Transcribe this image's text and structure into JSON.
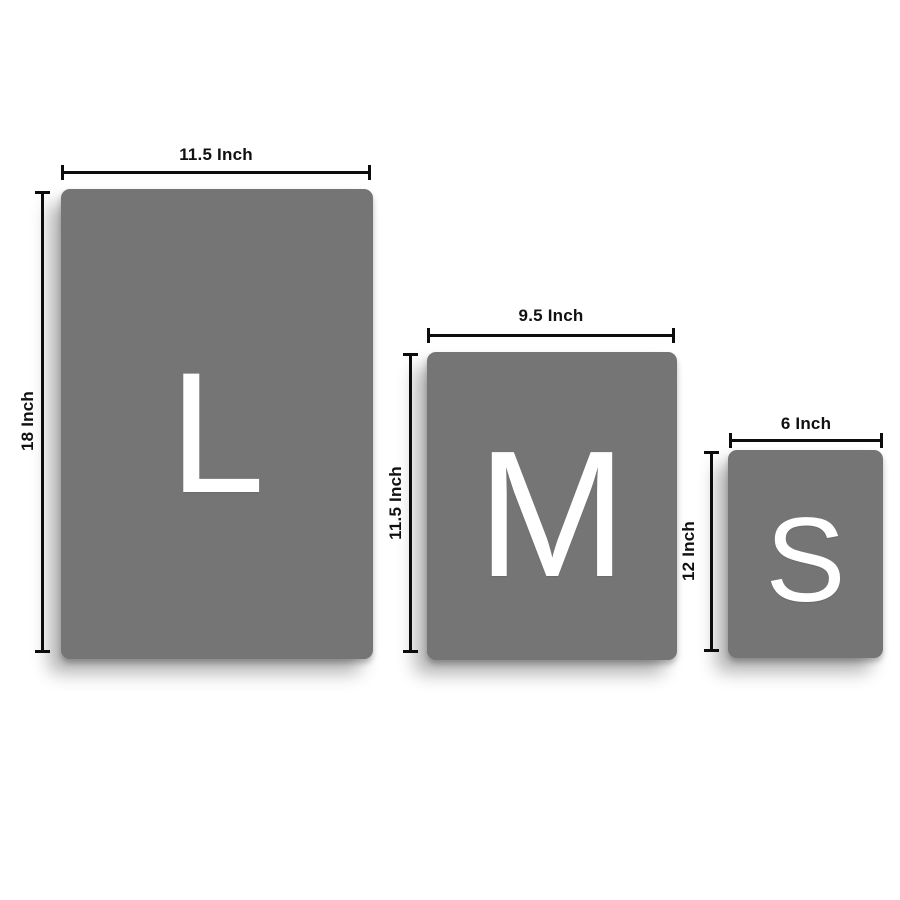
{
  "colors": {
    "background": "#ffffff",
    "panel": "#757575",
    "letter": "#ffffff",
    "line": "#0d0d0d",
    "label_text": "#111111"
  },
  "sizes": [
    {
      "name": "Large",
      "letter": "L",
      "width_label": "11.5 Inch",
      "height_label": "18 Inch"
    },
    {
      "name": "Medium",
      "letter": "M",
      "width_label": "9.5 Inch",
      "height_label": "11.5 Inch"
    },
    {
      "name": "Small",
      "letter": "S",
      "width_label": "6 Inch",
      "height_label": "12 Inch"
    }
  ]
}
